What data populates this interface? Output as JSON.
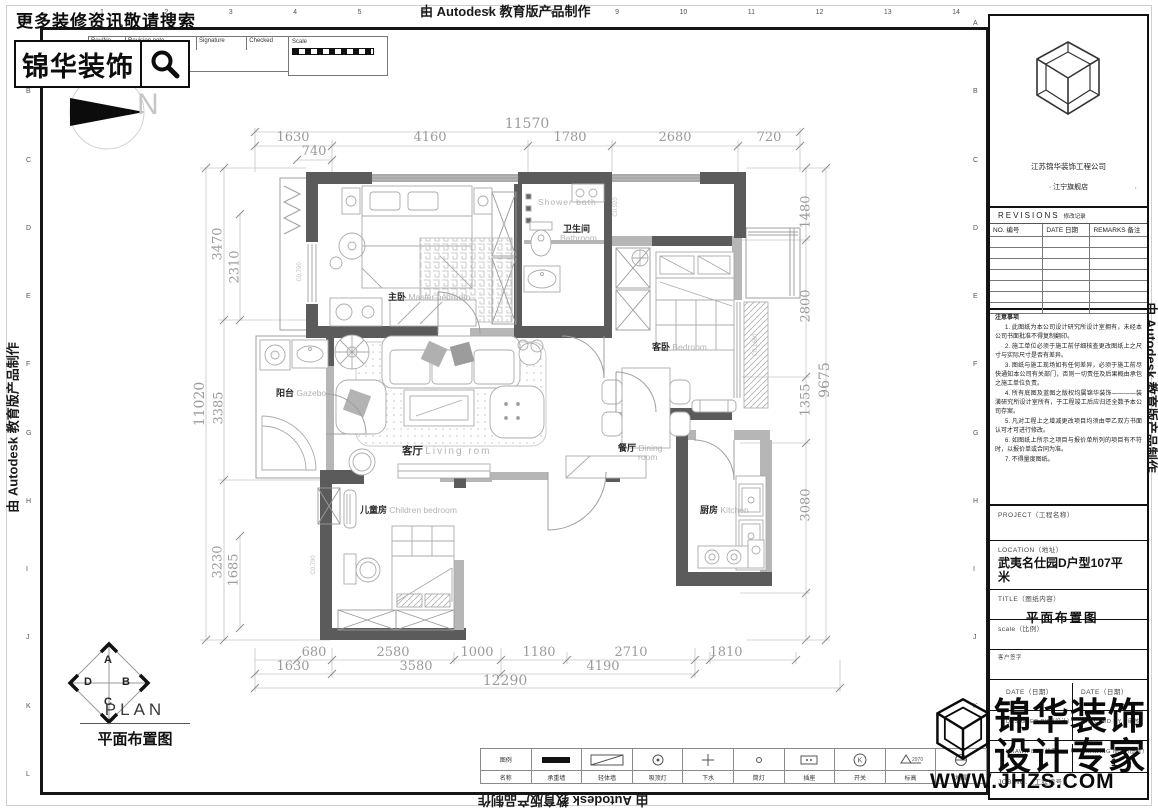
{
  "autodesk": "由 Autodesk 教育版产品制作",
  "header": {
    "slogan": "更多装修资讯敬请搜索",
    "brand": "锦华装饰",
    "search_icon": "magnifier"
  },
  "revision_strip": {
    "rev_no": "Rev/No",
    "note": "Revision note",
    "signature": "Signature",
    "checked": "Checked",
    "scale": "Scale"
  },
  "ruler": {
    "cols": [
      "1",
      "2",
      "3",
      "4",
      "5",
      "6",
      "7",
      "8",
      "9",
      "10",
      "11",
      "12",
      "13",
      "14"
    ],
    "rows": [
      "A",
      "B",
      "C",
      "D",
      "E",
      "F",
      "G",
      "H",
      "I",
      "J",
      "K",
      "L"
    ]
  },
  "north": {
    "label": "N"
  },
  "plan": {
    "title_en": "PLAN",
    "title_zh": "平面布置图",
    "compass": {
      "top": "A",
      "right": "B",
      "bottom": "C",
      "left": "D"
    },
    "window_codes": {
      "c1": "C0.790",
      "c2": "C0.920",
      "c3": "C0.1680",
      "c4": "C0.790"
    }
  },
  "rooms": {
    "master": {
      "zh": "主卧",
      "en": "Master bedroom"
    },
    "shower": {
      "en": "Shower bath"
    },
    "bath": {
      "zh": "卫生间",
      "en": "Bathroom"
    },
    "guest": {
      "zh": "客卧",
      "en": "Bedroom"
    },
    "balcony": {
      "zh": "阳台",
      "en": "Gazebo"
    },
    "living": {
      "zh": "客厅",
      "en": "Living rom"
    },
    "dining": {
      "zh": "餐厅",
      "en": "Dining",
      "en2": "room"
    },
    "children": {
      "zh": "儿童房",
      "en": "Children bedroom"
    },
    "kitchen": {
      "zh": "厨房",
      "en": "Kitchen"
    }
  },
  "dims": {
    "top_total": "11570",
    "t1": "1630",
    "t2": "4160",
    "t3": "1780",
    "t4": "2680",
    "t5": "720",
    "t_sub": "740",
    "b1": "680",
    "b2": "2580",
    "b3": "1000",
    "b4": "1180",
    "b5": "2710",
    "b6": "1810",
    "b7": "1630",
    "b8": "3580",
    "b9": "4190",
    "bottom_total": "12290",
    "l1": "3470",
    "l2": "2310",
    "l3": "3385",
    "l4": "3230",
    "l5": "1685",
    "left_total": "11020",
    "r1": "1480",
    "r2": "2800",
    "r3": "1355",
    "r4": "3080",
    "right_total": "9675"
  },
  "colors": {
    "wall_dark": "#5b5b5b",
    "wall_light": "#b6b6b6",
    "line_gray": "#a8a8a8",
    "dim_text": "#9b9b9b"
  },
  "legend": {
    "items": [
      {
        "icon": "legend-title",
        "top": "图例",
        "label": "名称"
      },
      {
        "icon": "solid-wall",
        "label": "承重墙"
      },
      {
        "icon": "light-wall",
        "label": "轻体墙"
      },
      {
        "icon": "ceiling-lamp",
        "label": "吸顶灯"
      },
      {
        "icon": "cross",
        "label": "下水"
      },
      {
        "icon": "downlight",
        "label": "筒灯"
      },
      {
        "icon": "socket",
        "label": "插座"
      },
      {
        "icon": "switch",
        "label": "开关"
      },
      {
        "icon": "elevation",
        "label": "标高",
        "value": "2970"
      },
      {
        "icon": "floor-drain",
        "label": "地漏"
      }
    ]
  },
  "title_block": {
    "company": "江苏锦华装饰工程公司",
    "store": "· 江宁旗舰店",
    "store_dot": "·",
    "revisions": {
      "title": "REVISIONS",
      "title_zh": "修改记录",
      "cols": [
        "NO. 编号",
        "DATE 日期",
        "REMARKS 备注"
      ],
      "empty_rows": 7
    },
    "notes_title": "注意事项",
    "notes": [
      "1. 此图纸为本公司设计研究所设计室拥有，未经本公司书面批准不得复制翻印。",
      "2. 施工单位必须于施工前仔细核查更改图纸上之尺寸与实际尺寸是否有差异。",
      "3. 图纸与施工现场如有任何差异，必须于施工前尽快通知本公司有关部门，否则一切责任及后果概由承包之施工单位负责。",
      "4. 所有底图及蓝图之版权均属锦华装饰————装潢研究所设计室所有，于工程竣工后应归还全数予本公司存案。",
      "5. 凡对工程上之增减更改项目均须由甲乙双方书面认可才可进行修改。",
      "6. 如图纸上所示之项目与报价单所列的项目有不符时，以报价单或合同为准。",
      "7. 不得量度图纸。"
    ],
    "fields": {
      "project": "PROJECT（工程名称）",
      "location": "LOCATION（地址）",
      "location_value": "武夷名仕园D户型107平米",
      "title": "TITLE（图纸内容）",
      "title_value": "平面布置图",
      "scale": "scale（比例）",
      "client_sign": "客户签字",
      "date1": "DATE（日期）",
      "date2": "DATE（日期）",
      "designed_by": "DESIGNED BY（设计）",
      "checked_by": "CHECKED BY（审核）",
      "drawn_by": "DRAWN BY（绘图）",
      "drawing_no": "DRAWING NO.（图号）",
      "drawing_no_value": "1",
      "job_no": "JOB NO.（工程编号）"
    }
  },
  "watermark": {
    "line1": "锦华装饰",
    "line2": "设计专家",
    "url": "WWW.JHZS.COM"
  }
}
